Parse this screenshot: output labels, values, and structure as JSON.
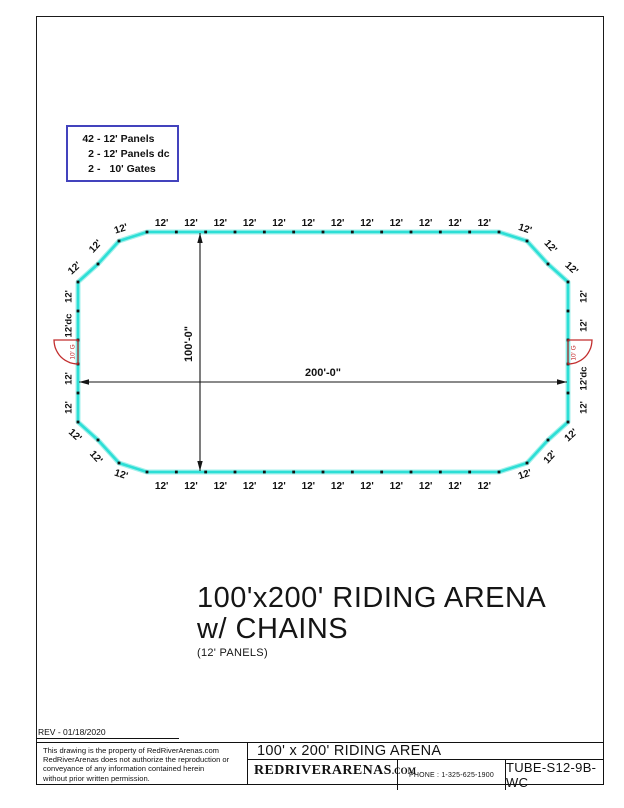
{
  "legend": {
    "separator": "-",
    "items": [
      {
        "qty": "42",
        "desc": "12' Panels"
      },
      {
        "qty": "2",
        "desc": "12' Panels dc"
      },
      {
        "qty": "2",
        "desc": "10' Gates"
      }
    ]
  },
  "drawing": {
    "panel_label": "12'",
    "dc_label": "12'dc",
    "gate_label": "10' G",
    "width_dim": "200'-0\"",
    "height_dim": "100'-0\"",
    "top_panels": 12,
    "bottom_panels": 12,
    "corner_panels": 3,
    "left_sections": [
      "12'",
      "12'dc",
      "GATE",
      "12'",
      "12'"
    ],
    "right_sections": [
      "12'",
      "12'",
      "GATE",
      "12'dc",
      "12'"
    ],
    "colors": {
      "wall": "#2ddfd6",
      "wall_halo": "#a5f1ec",
      "gate": "#c22e2e",
      "legend_border": "#4343bd",
      "line": "#151515"
    }
  },
  "main_title": {
    "line1": "100'x200' RIDING ARENA",
    "line2": "w/ CHAINS",
    "line3": "(12' PANELS)"
  },
  "page": {
    "rev_text": "REV - 01/18/2020",
    "disclaimer_lines": [
      "This drawing is the property of RedRiverArenas.com",
      "RedRiverArenas does not authorize the reproduction or",
      "conveyance of any information contained herein",
      "without prior written permission."
    ],
    "title_block": {
      "drawing_title": "100' x 200' RIDING ARENA",
      "company": "REDRIVERARENAS",
      "company_suffix": ".COM",
      "phone": "PHONE : 1-325-625-1900",
      "part_number": "TUBE-S12-9B-WC"
    }
  }
}
